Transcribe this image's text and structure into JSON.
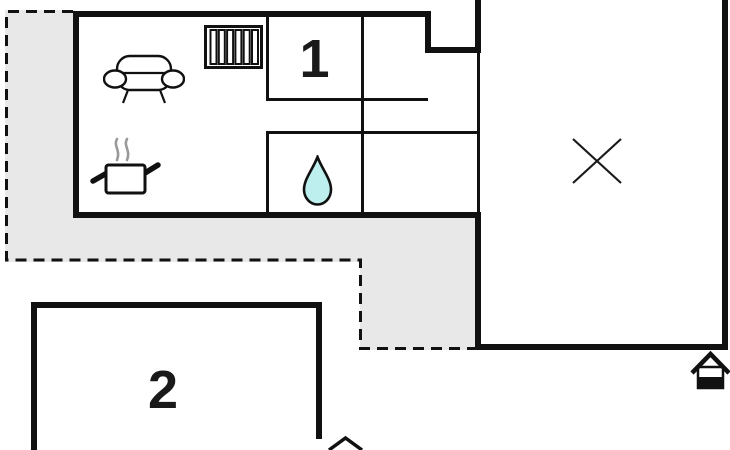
{
  "page": {
    "type": "floor-plan"
  },
  "colors": {
    "background": "#ffffff",
    "wall": "#111111",
    "terrace_fill": "#e8e8e8",
    "water_drop_fill": "#bdefef",
    "steam": "#999999"
  },
  "rooms": {
    "room1": {
      "label": "1"
    },
    "room2": {
      "label": "2"
    }
  },
  "icons": [
    "sofa-icon",
    "radiator-icon",
    "cooking-pot-icon",
    "water-drop-icon",
    "cross-marker-icon",
    "entrance-house-icon",
    "entrance-house-partial-icon"
  ]
}
